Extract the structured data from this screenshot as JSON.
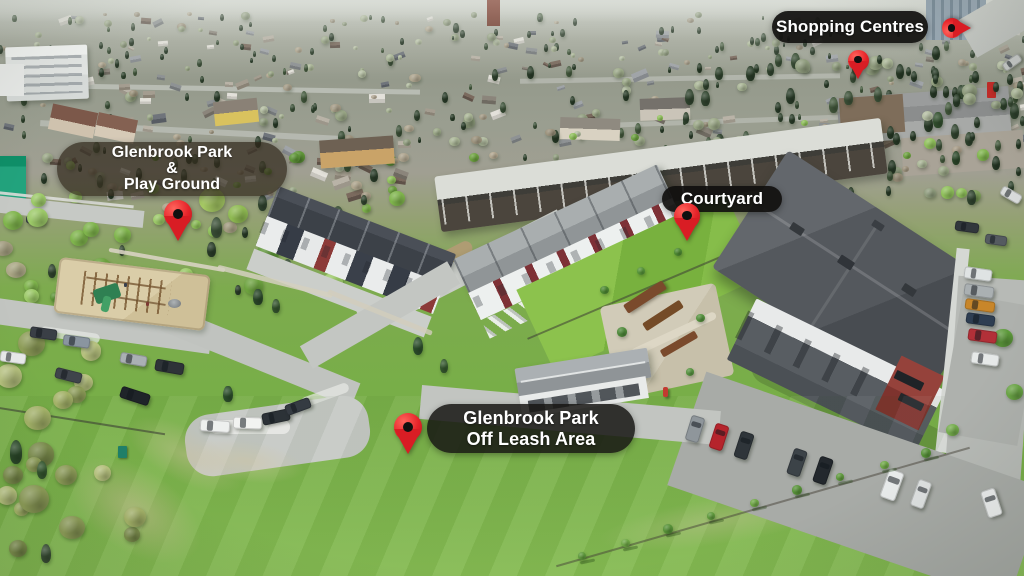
{
  "annotations": {
    "shopping_centres": {
      "text": "Shopping Centres"
    },
    "park_playground": {
      "line1": "Glenbrook Park",
      "line2": "&",
      "line3": "Play Ground"
    },
    "courtyard": {
      "text": "Courtyard"
    },
    "off_leash": {
      "line1": "Glenbrook Park",
      "line2": "Off Leash Area"
    }
  },
  "pins": [
    {
      "name": "pin-icon-shopping-centres-road",
      "x": 971,
      "y": 28,
      "size": 20,
      "dir": "right"
    },
    {
      "name": "pin-icon-shopping-centres-area",
      "x": 858,
      "y": 80,
      "size": 21,
      "dir": "down"
    },
    {
      "name": "pin-icon-playground",
      "x": 178,
      "y": 241,
      "size": 28,
      "dir": "down"
    },
    {
      "name": "pin-icon-courtyard",
      "x": 687,
      "y": 241,
      "size": 26,
      "dir": "down"
    },
    {
      "name": "pin-icon-off-leash",
      "x": 408,
      "y": 454,
      "size": 28,
      "dir": "down"
    }
  ],
  "palette": {
    "pin_red": "#e62329",
    "pin_hole": "#101010",
    "label_dark_bg": "rgba(16,15,14,0.92)",
    "label_mid_bg": "rgba(22,21,19,0.85)",
    "label_soft_bg": "rgba(48,40,28,0.72)",
    "label_text": "#ffffff",
    "grass_bright": "#7ab34a",
    "asphalt": "#bfc3bf",
    "sand": "#d4c69e",
    "roof_dark": "#4e5257",
    "accent_red_wall": "#8c3a33"
  }
}
